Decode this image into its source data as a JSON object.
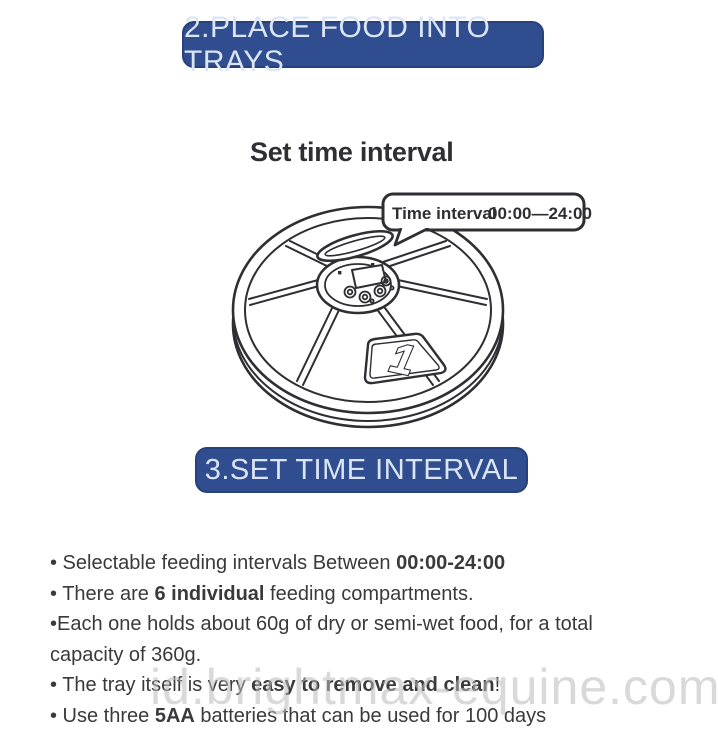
{
  "banners": {
    "step2_label": "2.PLACE FOOD INTO TRAYS",
    "step3_label": "3.SET TIME INTERVAL"
  },
  "diagram": {
    "heading": "Set time interval",
    "bubble": {
      "label": "Time interval",
      "value": "00:00—24:00"
    },
    "tray_number": "1"
  },
  "features": {
    "lines": [
      {
        "pre": "• Selectable feeding intervals Between ",
        "bold": "00:00-24:00",
        "post": ""
      },
      {
        "pre": "• There are ",
        "bold": "6 individual",
        "post": " feeding compartments."
      },
      {
        "pre": "•Each one holds about 60g of dry or semi-wet food, for a total",
        "bold": "",
        "post": ""
      },
      {
        "pre": "capacity of 360g.",
        "bold": "",
        "post": ""
      },
      {
        "pre": "• The tray itself is very ",
        "bold": "easy to remove and clean",
        "post": "!"
      },
      {
        "pre": "• Use three ",
        "bold": "5AA",
        "post": " batteries that can be used for 100 days"
      }
    ]
  },
  "watermark": {
    "text": "id.brightmax-equine.com"
  },
  "colors": {
    "banner_blue": "#2f4d8f",
    "banner_text": "#dbe5f6",
    "ink": "#2e2e33",
    "body_text": "#3a3a3c",
    "watermark_gray": "#bababa"
  }
}
